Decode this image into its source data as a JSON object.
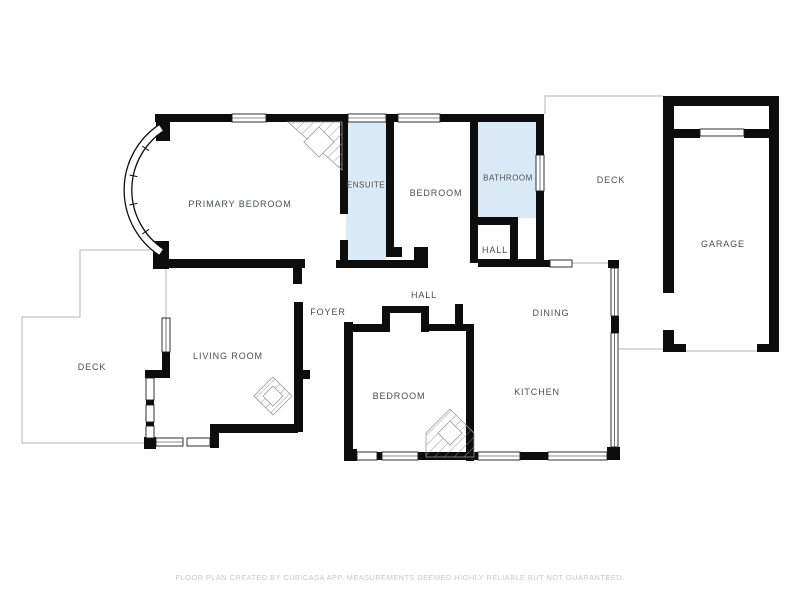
{
  "footer": {
    "text": "FLOOR PLAN CREATED BY CUBICASA APP. MEASUREMENTS DEEMED HIGHLY RELIABLE BUT NOT GUARANTEED."
  },
  "colors": {
    "background": "#ffffff",
    "wall": "#0d0d0d",
    "wet_room_fill": "#d9e9f6",
    "label_text": "#4a4e52",
    "deck_outline": "#c2c2c2",
    "footer_text": "#c9c9c9"
  },
  "rooms": {
    "primary_bedroom": {
      "label": "PRIMARY BEDROOM",
      "highlighted": false
    },
    "ensuite": {
      "label": "ENSUITE",
      "highlighted": true
    },
    "bedroom_upper": {
      "label": "BEDROOM",
      "highlighted": false
    },
    "bathroom": {
      "label": "BATHROOM",
      "highlighted": true
    },
    "hall_upper": {
      "label": "HALL",
      "highlighted": false
    },
    "deck_upper": {
      "label": "DECK",
      "highlighted": false
    },
    "garage": {
      "label": "GARAGE",
      "highlighted": false
    },
    "foyer": {
      "label": "FOYER",
      "highlighted": false
    },
    "hall_main": {
      "label": "HALL",
      "highlighted": false
    },
    "dining": {
      "label": "DINING",
      "highlighted": false
    },
    "living_room": {
      "label": "LIVING ROOM",
      "highlighted": false
    },
    "deck_lower": {
      "label": "DECK",
      "highlighted": false
    },
    "bedroom_lower": {
      "label": "BEDROOM",
      "highlighted": false
    },
    "kitchen": {
      "label": "KITCHEN",
      "highlighted": false
    }
  }
}
